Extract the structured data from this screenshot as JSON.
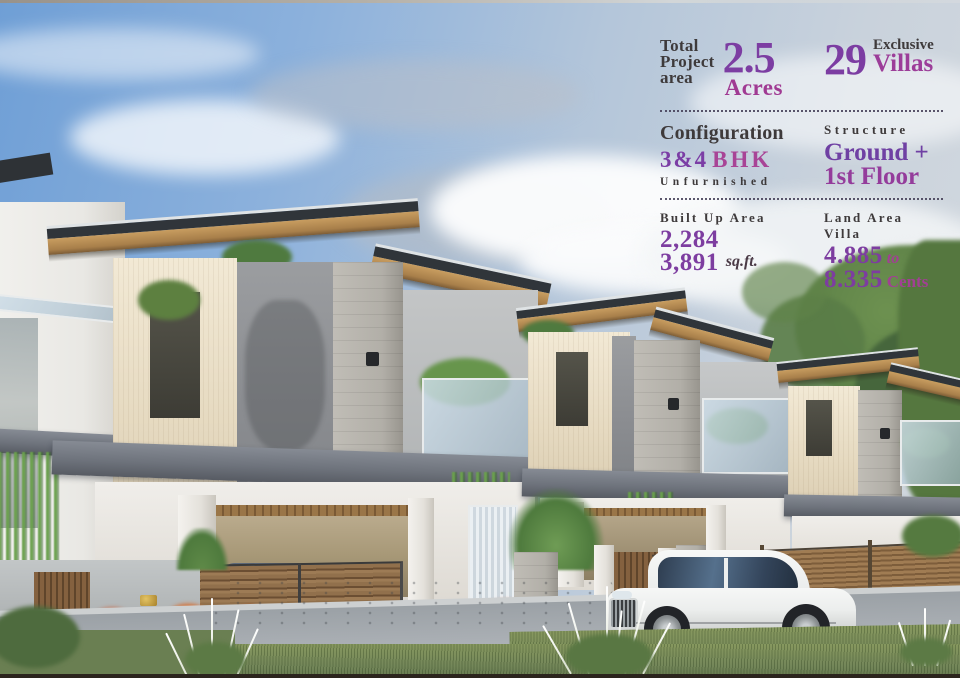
{
  "panel": {
    "total_project": {
      "label_line1": "Total",
      "label_line2": "Project",
      "label_line3": "area",
      "value": "2.5",
      "unit": "Acres"
    },
    "exclusive_villas": {
      "value": "29",
      "label_line1": "Exclusive",
      "label_line2": "Villas"
    },
    "configuration": {
      "label": "Configuration",
      "value_main": "3&4",
      "value_suffix": "BHK",
      "subtext": "Unfurnished"
    },
    "structure": {
      "label": "Structure",
      "value_line1": "Ground +",
      "value_line2": "1st Floor"
    },
    "built_up_area": {
      "label": "Built Up Area",
      "value_min": "2,284",
      "value_max": "3,891",
      "unit": "sq.ft."
    },
    "land_area": {
      "label": "Land Area Villa",
      "value_min": "4.885",
      "connector": "to",
      "value_max": "8.335",
      "unit": "Cents"
    }
  },
  "colors": {
    "accent_purple": "#7b3da5",
    "accent_magenta": "#a03c94",
    "text_dark": "#3e3a3b",
    "divider_dotted": "#403a52"
  }
}
